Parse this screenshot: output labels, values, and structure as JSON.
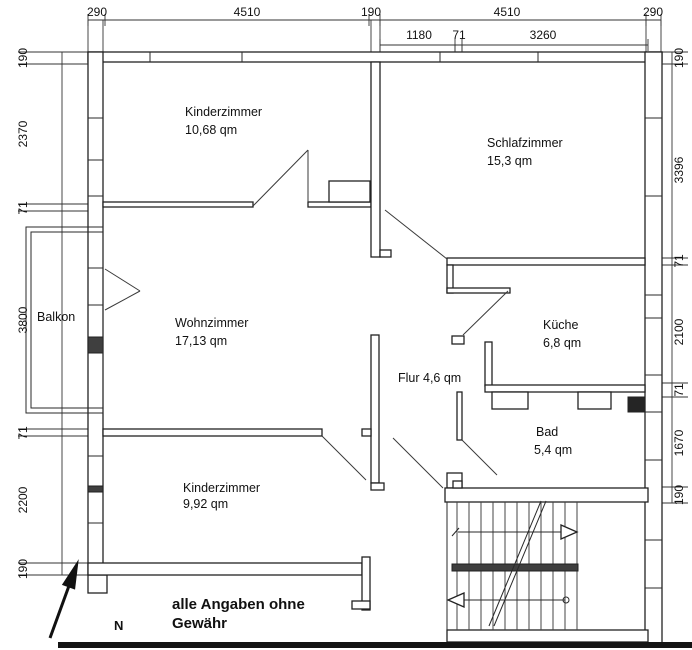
{
  "plan": {
    "rooms": [
      {
        "id": "kinderzimmer-top",
        "name": "Kinderzimmer",
        "area": "10,68 qm"
      },
      {
        "id": "schlafzimmer",
        "name": "Schlafzimmer",
        "area": "15,3 qm"
      },
      {
        "id": "wohnzimmer",
        "name": "Wohnzimmer",
        "area": "17,13 qm"
      },
      {
        "id": "kueche",
        "name": "Küche",
        "area": "6,8 qm"
      },
      {
        "id": "bad",
        "name": "Bad",
        "area": "5,4 qm"
      },
      {
        "id": "kinderzimmer-bottom",
        "name": "Kinderzimmer",
        "area": "9,92 qm"
      },
      {
        "id": "balkon",
        "name": "Balkon"
      },
      {
        "id": "flur",
        "label": "Flur 4,6 qm"
      }
    ],
    "dimensions": {
      "top_row1": [
        "290",
        "4510",
        "190",
        "4510",
        "290"
      ],
      "top_row2": [
        "1180",
        "71",
        "3260"
      ],
      "left": [
        "190",
        "2370",
        "71",
        "3800",
        "71",
        "2200",
        "190"
      ],
      "right": [
        "190",
        "3396",
        "71",
        "2100",
        "71",
        "1670",
        "190"
      ]
    },
    "annotations": {
      "north": "N",
      "disclaimer_line1": "alle Angaben ohne",
      "disclaimer_line2": "Gewähr"
    },
    "colors": {
      "line": "#222222",
      "background": "#ffffff",
      "bottom_border": "#141414"
    }
  }
}
